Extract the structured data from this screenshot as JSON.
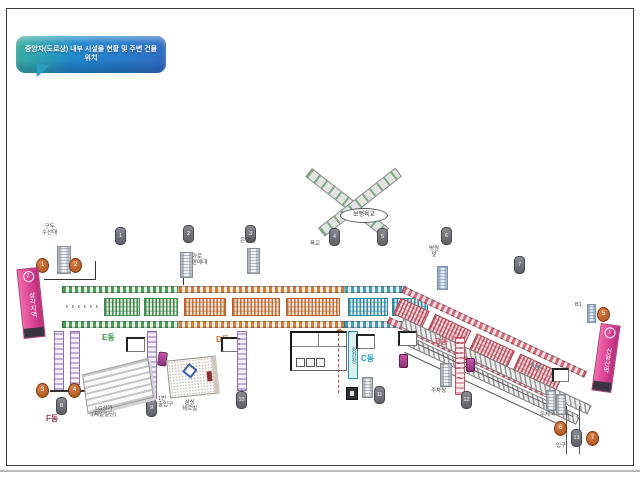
{
  "title": "중앙차(도로상) 내부 시설물 현황 및 주변 건물 위치",
  "stations": {
    "left": {
      "name": "삼각지역",
      "num": "2"
    },
    "right": {
      "name": "신용산역",
      "num": "1"
    }
  },
  "blocks": {
    "a": "A동",
    "b": "B동",
    "c": "C동",
    "d": "D동",
    "e": "E동",
    "f": "F동"
  },
  "overpass": {
    "label": "보행육교",
    "note": "육교"
  },
  "pills": [
    "1",
    "2",
    "3",
    "4",
    "5",
    "6",
    "7",
    "8",
    "9",
    "10",
    "11",
    "12",
    "13"
  ],
  "circles": [
    "1",
    "2",
    "3",
    "4",
    "5",
    "6",
    "7"
  ],
  "labels": {
    "booth1": [
      "구두",
      "수선대"
    ],
    "booth2": [
      "가로",
      "판매대"
    ],
    "bank": "은행앞",
    "hospital": [
      "병원",
      "앞"
    ],
    "exit": [
      "1번",
      "출입구"
    ],
    "parking": "주차장",
    "post": "우체국",
    "entrance": "입구",
    "b1": "B1",
    "building1": [
      "LG상가",
      "(제일빌딩)"
    ],
    "building2": [
      "삼성",
      "쉐르빌"
    ],
    "platform": "승강장"
  }
}
